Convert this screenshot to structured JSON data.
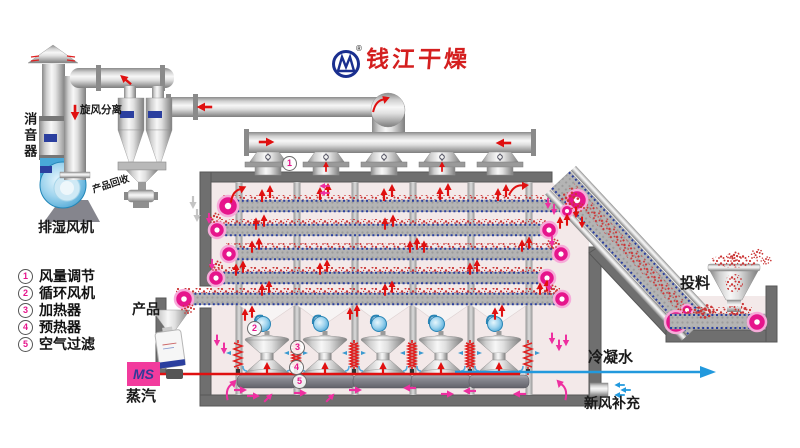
{
  "brand": {
    "name": "钱江干燥",
    "registered": "®"
  },
  "legend": {
    "items": [
      {
        "num": "1",
        "label": "风量调节"
      },
      {
        "num": "2",
        "label": "循环风机"
      },
      {
        "num": "3",
        "label": "加热器"
      },
      {
        "num": "4",
        "label": "预热器"
      },
      {
        "num": "5",
        "label": "空气过滤"
      }
    ]
  },
  "labels": {
    "silencer": "消音器",
    "exhaust_fan": "排湿风机",
    "cyclone_separator": "旋风分离",
    "product_recovery": "产品回收",
    "feeding": "投料",
    "product": "产品",
    "steam_box": "MS",
    "steam": "蒸汽",
    "condensate_water": "冷凝水",
    "fresh_air_makeup": "新风补充"
  },
  "callouts": [
    {
      "num": "1"
    },
    {
      "num": "2"
    },
    {
      "num": "3"
    },
    {
      "num": "4"
    },
    {
      "num": "5"
    }
  ],
  "colors": {
    "accent_red": "#e01010",
    "flow_pink": "#ee2fa0",
    "roller_magenta": "#e6158c",
    "ms_box_pink": "#f23b9d",
    "fan_blue": "#2f9fd6",
    "water_blue": "#2299dd",
    "logo_red": "#d41f1f",
    "logo_blue": "#1a2f8f",
    "chamber_interior": "#f3e9e9",
    "wall_gray": "#6f6f6f",
    "belt_edge_blue": "#2a3f9e"
  }
}
